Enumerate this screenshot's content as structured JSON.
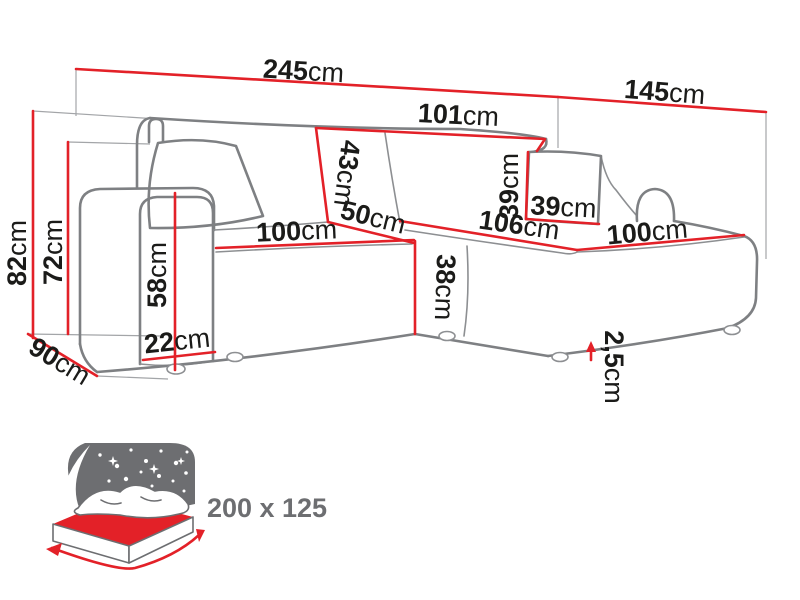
{
  "diagram_title": "Corner sofa dimensions diagram",
  "default_unit": "cm",
  "dimensions": {
    "total_width": {
      "value": "245",
      "unit": "cm"
    },
    "chaise_depth": {
      "value": "145",
      "unit": "cm"
    },
    "total_height": {
      "value": "82",
      "unit": "cm"
    },
    "frame_height": {
      "value": "72",
      "unit": "cm"
    },
    "side_depth": {
      "value": "90",
      "unit": "cm"
    },
    "backrest_width": {
      "value": "101",
      "unit": "cm"
    },
    "backrest_height": {
      "value": "43",
      "unit": "cm"
    },
    "corner_seat_width": {
      "value": "50",
      "unit": "cm"
    },
    "seat_width": {
      "value": "100",
      "unit": "cm"
    },
    "seat_height": {
      "value": "38",
      "unit": "cm"
    },
    "chaise_seat_length": {
      "value": "106",
      "unit": "cm"
    },
    "chaise_seat_width": {
      "value": "100",
      "unit": "cm"
    },
    "cushion_height": {
      "value": "39",
      "unit": "cm"
    },
    "cushion_width": {
      "value": "39",
      "unit": "cm"
    },
    "armrest_height": {
      "value": "58",
      "unit": "cm"
    },
    "armrest_width": {
      "value": "22",
      "unit": "cm"
    },
    "feet_height": {
      "value": "2,5",
      "unit": "cm"
    }
  },
  "sleeping_function": {
    "dimensions_label": "200 x 125"
  },
  "colors": {
    "dimension_red": "#e32128",
    "sofa_outline_gray": "#7e8083",
    "extension_gray": "#a3a5a8",
    "icon_gray": "#6d6e71",
    "label_black": "#1b1b19"
  }
}
